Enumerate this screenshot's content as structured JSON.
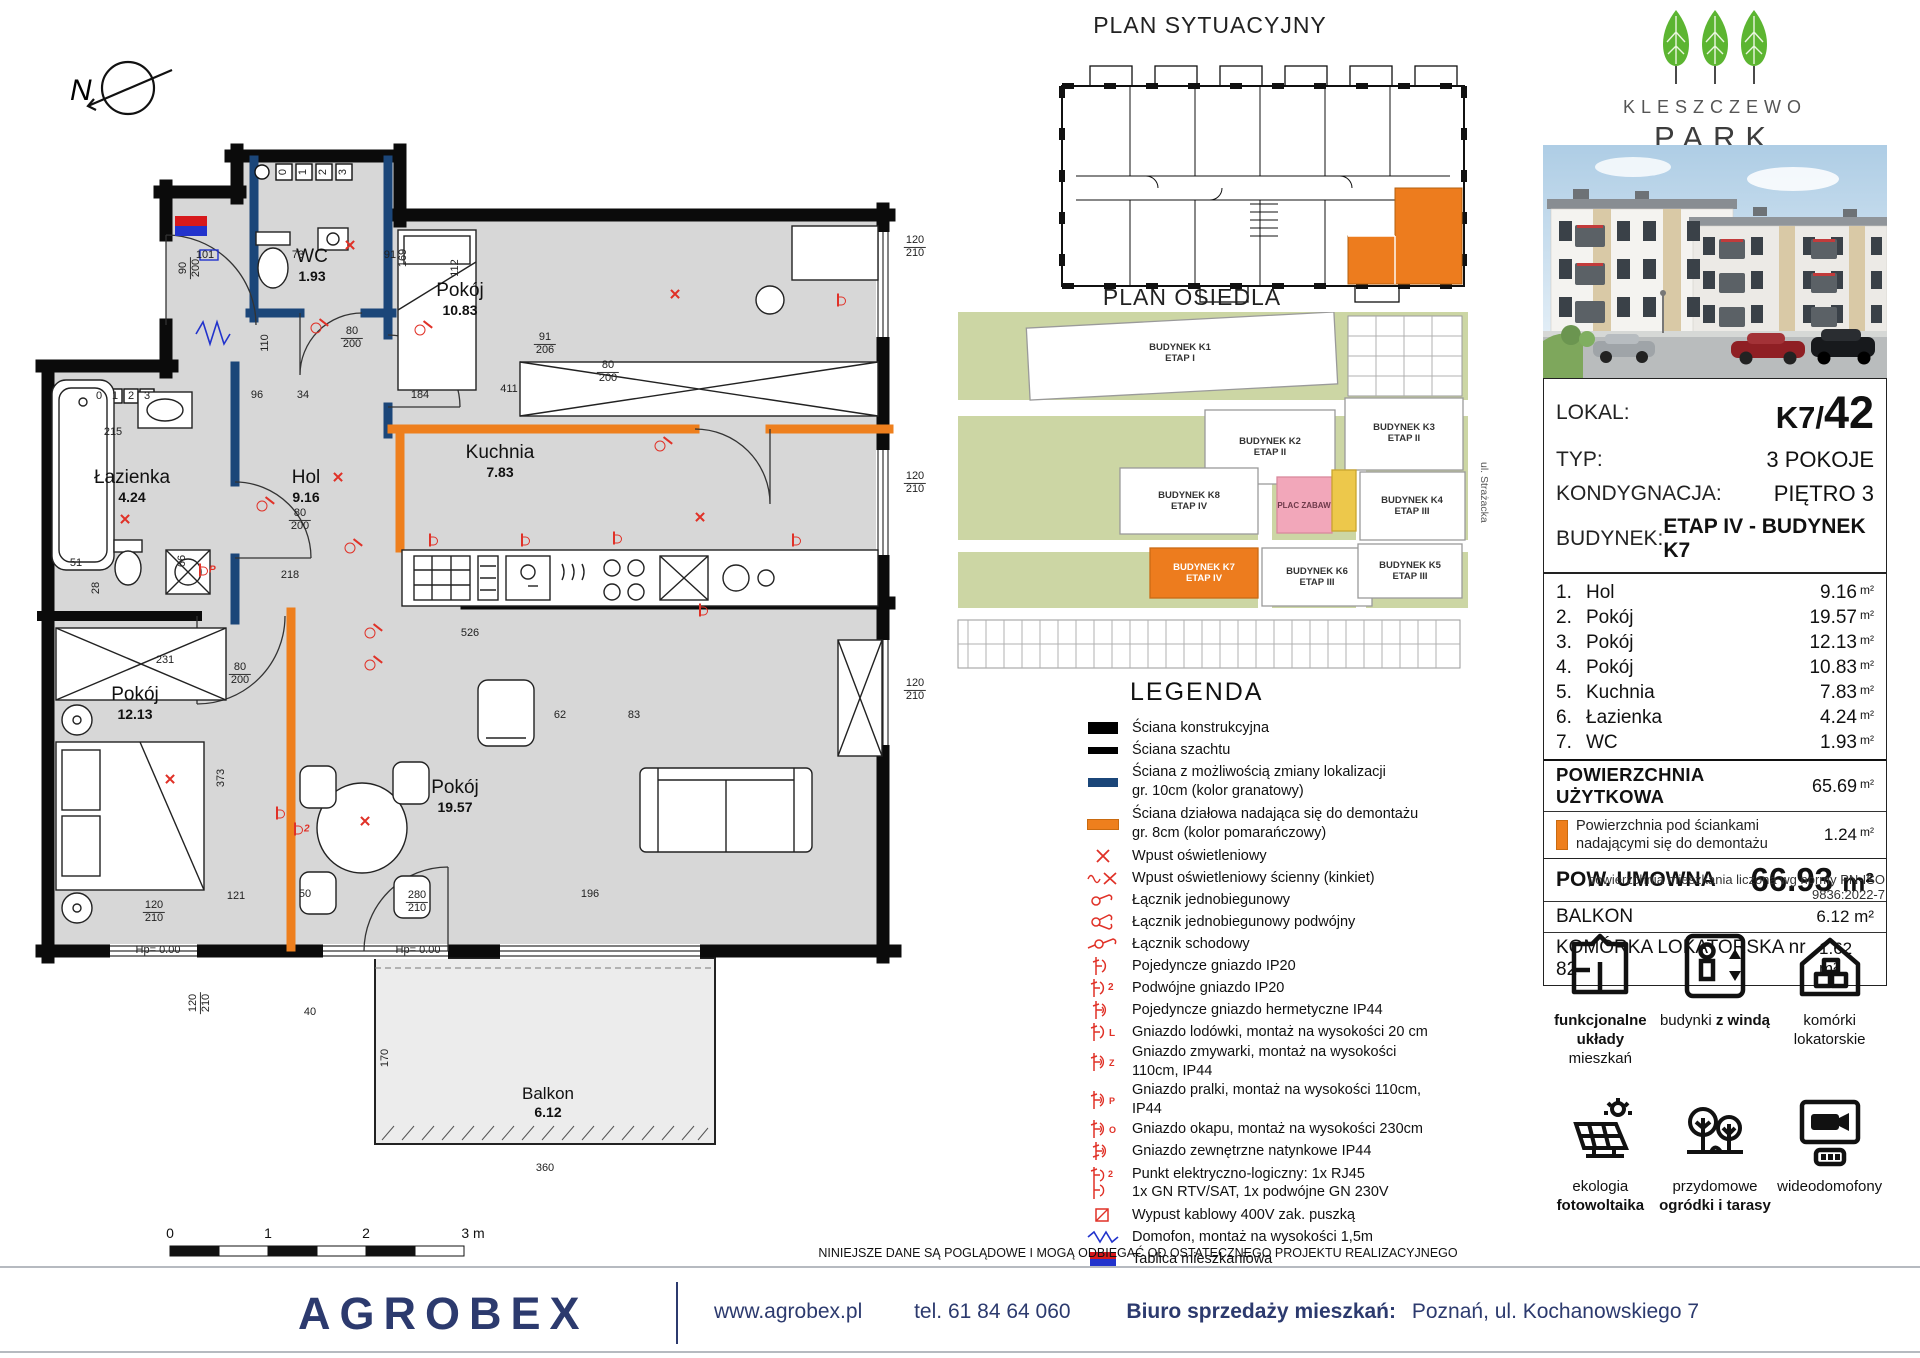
{
  "page": {
    "disclaimer": "NINIEJSZE DANE SĄ POGLĄDOWE I MOGĄ ODBIEGAĆ OD OSTATECZNEGO PROJEKTU REALIZACYJNEGO"
  },
  "north": {
    "label": "N"
  },
  "floorplan": {
    "rooms": [
      {
        "name": "WC",
        "area": "1.93"
      },
      {
        "name": "Pokój",
        "area": "10.83"
      },
      {
        "name": "Kuchnia",
        "area": "7.83"
      },
      {
        "name": "Hol",
        "area": "9.16"
      },
      {
        "name": "Łazienka",
        "area": "4.24"
      },
      {
        "name": "Pokój",
        "area": "12.13"
      },
      {
        "name": "Pokój",
        "area": "19.57"
      },
      {
        "name": "Balkon",
        "area": "6.12"
      }
    ],
    "scale": [
      "0",
      "1",
      "2",
      "3 m"
    ],
    "dims": [
      {
        "t": "120",
        "b": "210",
        "x": 915,
        "y": 247
      },
      {
        "t": "120",
        "b": "210",
        "x": 915,
        "y": 483
      },
      {
        "t": "120",
        "b": "210",
        "x": 915,
        "y": 690
      },
      {
        "t": "80",
        "b": "200",
        "x": 352,
        "y": 338
      },
      {
        "t": "90",
        "b": "200",
        "x": 190,
        "y": 268,
        "r": 90
      },
      {
        "t": "80",
        "b": "200",
        "x": 608,
        "y": 372
      },
      {
        "t": "91",
        "b": "206",
        "x": 545,
        "y": 344
      },
      {
        "t": "80",
        "b": "200",
        "x": 300,
        "y": 520
      },
      {
        "t": "80",
        "b": "200",
        "x": 240,
        "y": 674
      },
      {
        "t": "169",
        "x": 404,
        "y": 258,
        "r": 90
      },
      {
        "t": "112",
        "x": 456,
        "y": 268,
        "r": 90
      },
      {
        "t": "411",
        "x": 509,
        "y": 390
      },
      {
        "t": "526",
        "x": 470,
        "y": 634
      },
      {
        "t": "218",
        "x": 290,
        "y": 576
      },
      {
        "t": "231",
        "x": 165,
        "y": 661
      },
      {
        "t": "373",
        "x": 222,
        "y": 778,
        "r": 90
      },
      {
        "t": "121",
        "x": 236,
        "y": 897
      },
      {
        "t": "120",
        "b": "210",
        "x": 154,
        "y": 912
      },
      {
        "t": "50",
        "x": 305,
        "y": 895
      },
      {
        "t": "280",
        "b": "210",
        "x": 417,
        "y": 902
      },
      {
        "t": "196",
        "x": 590,
        "y": 895
      },
      {
        "t": "215",
        "x": 113,
        "y": 433
      },
      {
        "t": "51",
        "x": 76,
        "y": 564
      },
      {
        "t": "28",
        "x": 97,
        "y": 588,
        "r": 90
      },
      {
        "t": "66",
        "x": 183,
        "y": 561,
        "r": 90
      },
      {
        "t": "40",
        "x": 310,
        "y": 1013
      },
      {
        "t": "360",
        "x": 545,
        "y": 1169
      },
      {
        "t": "170",
        "x": 386,
        "y": 1058,
        "r": 90
      },
      {
        "t": "96",
        "x": 257,
        "y": 396
      },
      {
        "t": "34",
        "x": 303,
        "y": 396
      },
      {
        "t": "184",
        "x": 420,
        "y": 396
      },
      {
        "t": "110",
        "x": 266,
        "y": 343,
        "r": 90
      },
      {
        "t": "101",
        "x": 205,
        "y": 256
      },
      {
        "t": "73",
        "x": 298,
        "y": 256
      },
      {
        "t": "91",
        "x": 390,
        "y": 256
      },
      {
        "t": "83",
        "x": 634,
        "y": 716
      },
      {
        "t": "62",
        "x": 560,
        "y": 716
      },
      {
        "t": "120",
        "b": "210",
        "x": 200,
        "y": 1003,
        "r": 90
      },
      {
        "t": "Hp= 0.00",
        "x": 158,
        "y": 951
      },
      {
        "t": "Hp= 0.00",
        "x": 418,
        "y": 951
      },
      {
        "t": "0",
        "x": 99,
        "y": 397
      },
      {
        "t": "1",
        "x": 115,
        "y": 397
      },
      {
        "t": "2",
        "x": 131,
        "y": 397
      },
      {
        "t": "3",
        "x": 147,
        "y": 397
      },
      {
        "t": "0",
        "x": 284,
        "y": 172,
        "r": 90
      },
      {
        "t": "1",
        "x": 304,
        "y": 172,
        "r": 90
      },
      {
        "t": "2",
        "x": 324,
        "y": 172,
        "r": 90
      },
      {
        "t": "3",
        "x": 344,
        "y": 172,
        "r": 90
      }
    ],
    "marks": [
      {
        "k": "x",
        "x": 350,
        "y": 246
      },
      {
        "k": "x",
        "x": 675,
        "y": 295
      },
      {
        "k": "x",
        "x": 700,
        "y": 518
      },
      {
        "k": "x",
        "x": 338,
        "y": 478
      },
      {
        "k": "x",
        "x": 125,
        "y": 520
      },
      {
        "k": "x",
        "x": 170,
        "y": 780
      },
      {
        "k": "x",
        "x": 365,
        "y": 822
      },
      {
        "k": "sw",
        "x": 316,
        "y": 328
      },
      {
        "k": "sw",
        "x": 262,
        "y": 506
      },
      {
        "k": "sw",
        "x": 350,
        "y": 548
      },
      {
        "k": "sw",
        "x": 370,
        "y": 633
      },
      {
        "k": "sw",
        "x": 370,
        "y": 665
      },
      {
        "k": "sw",
        "x": 660,
        "y": 446
      },
      {
        "k": "sw",
        "x": 420,
        "y": 330
      },
      {
        "k": "so",
        "x": 295,
        "y": 829,
        "l": "2"
      },
      {
        "k": "so",
        "x": 277,
        "y": 813
      },
      {
        "k": "so",
        "x": 430,
        "y": 540
      },
      {
        "k": "so",
        "x": 522,
        "y": 540
      },
      {
        "k": "so",
        "x": 614,
        "y": 538
      },
      {
        "k": "so",
        "x": 700,
        "y": 610
      },
      {
        "k": "so",
        "x": 793,
        "y": 540
      },
      {
        "k": "so",
        "x": 838,
        "y": 300
      },
      {
        "k": "so",
        "x": 200,
        "y": 570,
        "l": "P"
      }
    ]
  },
  "plan_sytuacyjny": {
    "title": "PLAN SYTUACYJNY"
  },
  "plan_osiedla": {
    "title": "PLAN OSIEDLA",
    "street": "ul. Strażacka",
    "plac_zabaw": "PLAC ZABAW",
    "buildings": [
      {
        "name": "BUDYNEK K1",
        "etap": "ETAP I"
      },
      {
        "name": "BUDYNEK K2",
        "etap": "ETAP II"
      },
      {
        "name": "BUDYNEK K3",
        "etap": "ETAP II"
      },
      {
        "name": "BUDYNEK K4",
        "etap": "ETAP III"
      },
      {
        "name": "BUDYNEK K5",
        "etap": "ETAP III"
      },
      {
        "name": "BUDYNEK K6",
        "etap": "ETAP III"
      },
      {
        "name": "BUDYNEK K7",
        "etap": "ETAP IV"
      },
      {
        "name": "BUDYNEK K8",
        "etap": "ETAP IV"
      }
    ]
  },
  "legend": {
    "title": "LEGENDA",
    "items": [
      {
        "label": "Ściana konstrukcyjna"
      },
      {
        "label": "Ściana szachtu"
      },
      {
        "label": "Ściana z możliwością zmiany lokalizacji",
        "label2": "gr. 10cm (kolor granatowy)"
      },
      {
        "label": "Ściana działowa nadająca się do demontażu",
        "label2": "gr. 8cm (kolor pomarańczowy)"
      },
      {
        "label": "Wpust oświetleniowy"
      },
      {
        "label": "Wpust oświetleniowy ścienny (kinkiet)"
      },
      {
        "label": "Łącznik jednobiegunowy"
      },
      {
        "label": "Łącznik jednobiegunowy podwójny"
      },
      {
        "label": "Łącznik schodowy"
      },
      {
        "label": "Pojedyncze gniazdo IP20"
      },
      {
        "label": "Podwójne gniazdo IP20"
      },
      {
        "label": "Pojedyncze gniazdo hermetyczne IP44"
      },
      {
        "label": "Gniazdo lodówki, montaż na wysokości 20 cm"
      },
      {
        "label": "Gniazdo zmywarki, montaż na wysokości 110cm,  IP44"
      },
      {
        "label": "Gniazdo pralki, montaż na wysokości 110cm, IP44"
      },
      {
        "label": "Gniazdo okapu, montaż na wysokości 230cm"
      },
      {
        "label": "Gniazdo zewnętrzne natynkowe IP44"
      },
      {
        "label": "Punkt elektryczno-logiczny: 1x RJ45",
        "label2": "1x GN RTV/SAT, 1x podwójne GN 230V"
      },
      {
        "label": "Wypust kablowy 400V zak. puszką"
      },
      {
        "label": "Domofon, montaż na wysokości 1,5m"
      },
      {
        "label": "Tablica mieszkaniowa"
      }
    ]
  },
  "sidebar": {
    "brand": {
      "line1": "KLESZCZEWO",
      "line2": "PARK"
    },
    "info": {
      "lokal_label": "LOKAL:",
      "lokal_prefix": "K7/",
      "lokal_number": "42",
      "typ_label": "TYP:",
      "typ_value": "3 POKOJE",
      "kondygnacja_label": "KONDYGNACJA:",
      "kondygnacja_value": "PIĘTRO 3",
      "budynek_label": "BUDYNEK:",
      "budynek_value": "ETAP IV - BUDYNEK  K7"
    },
    "rooms": [
      {
        "no": "1.",
        "name": "Hol",
        "area": "9.16"
      },
      {
        "no": "2.",
        "name": "Pokój",
        "area": "19.57"
      },
      {
        "no": "3.",
        "name": "Pokój",
        "area": "12.13"
      },
      {
        "no": "4.",
        "name": "Pokój",
        "area": "10.83"
      },
      {
        "no": "5.",
        "name": "Kuchnia",
        "area": "7.83"
      },
      {
        "no": "6.",
        "name": "Łazienka",
        "area": "4.24"
      },
      {
        "no": "7.",
        "name": "WC",
        "area": "1.93"
      }
    ],
    "unit": "m²",
    "totals": {
      "uzytkowa_label": "POWIERZCHNIA UŻYTKOWA",
      "uzytkowa_value": "65.69",
      "demontaz_label1": "Powierzchnia pod ściankami",
      "demontaz_label2": "nadającymi się do demontażu",
      "demontaz_value": "1.24",
      "umowna_label": "POW. UMOWNA",
      "umowna_value": "66.93",
      "balkon_label": "BALKON",
      "balkon_value": "6.12",
      "komorka_label": "KOMÓRKA LOKATORSKA nr 82",
      "komorka_value": "1.62",
      "norm_note": "powierzchnia mieszkania liczona wg normy PN-ISO 9836:2022-7"
    },
    "features": [
      {
        "l1b": "funkcjonalne układy",
        "l2": "mieszkań"
      },
      {
        "l1": "budynki ",
        "l1b": "z windą"
      },
      {
        "l1": "komórki",
        "l2": "lokatorskie"
      },
      {
        "l1": "ekologia",
        "l2b": "fotowoltaika"
      },
      {
        "l1": "przydomowe",
        "l2b": "ogródki i tarasy"
      },
      {
        "l1": "wideodomofony"
      }
    ]
  },
  "footer": {
    "brand": "AGROBEX",
    "website": "www.agrobex.pl",
    "phone": "tel. 61 84 64 060",
    "office_label": "Biuro sprzedaży mieszkań:",
    "office_address": "Poznań, ul. Kochanowskiego 7"
  },
  "colors": {
    "wall_black": "#0b0b0b",
    "wall_navy": "#1b4679",
    "wall_orange": "#ee7f1d",
    "electric_red": "#e03127",
    "floor_gray": "#d7d7d7",
    "leaf_green": "#5cb531",
    "map_green": "#ccd6a4",
    "map_pink": "#f2a7ba",
    "map_yellow": "#edc84b",
    "footer_navy": "#2c3a6e"
  }
}
